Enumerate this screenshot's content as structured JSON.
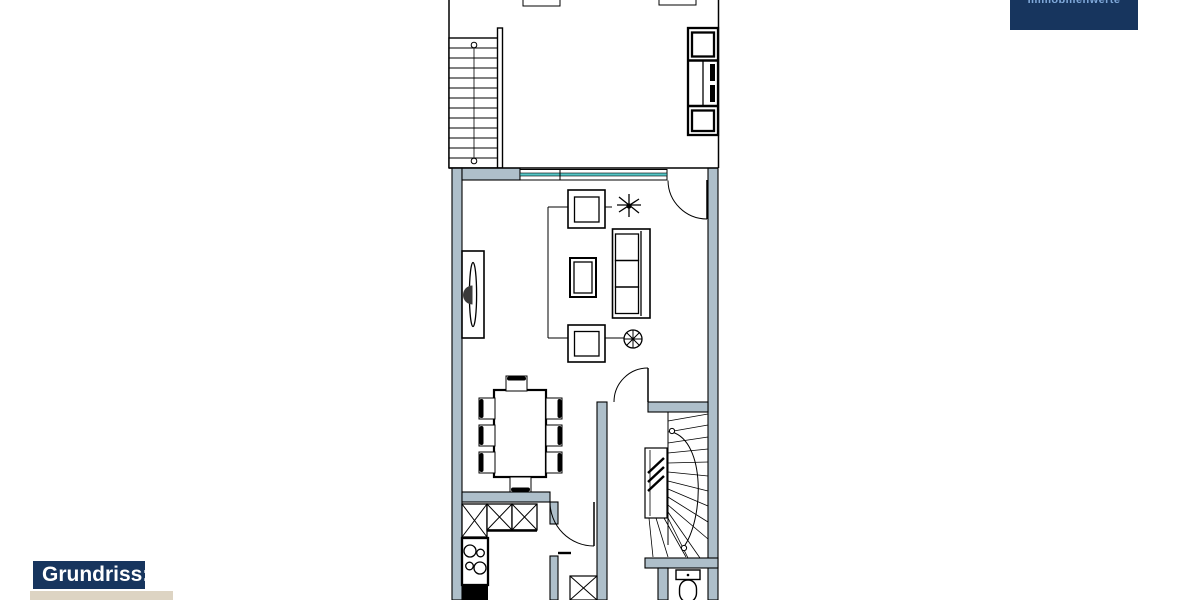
{
  "window": {
    "width": 1200,
    "height": 600,
    "background": "#ffffff"
  },
  "branding": {
    "logo_text": "Immobilienwerte"
  },
  "caption": {
    "label": "Grundriss:"
  },
  "colors": {
    "paper": "#ffffff",
    "navy": "#17355e",
    "logo_text": "#7fa8d9",
    "caption_text": "#ffffff",
    "beige": "#ddd4c3",
    "wall": "#aebfca",
    "window_glass": "#54c6c6",
    "line": "#000000"
  },
  "floorplan": {
    "type": "residential floor plan (Grundriss)",
    "rooms": [
      {
        "name": "upper-terrace-area"
      },
      {
        "name": "living-room"
      },
      {
        "name": "dining-area"
      },
      {
        "name": "kitchen"
      },
      {
        "name": "hallway"
      },
      {
        "name": "shower-room"
      },
      {
        "name": "wc"
      },
      {
        "name": "stair-hall"
      }
    ],
    "elements": [
      "straight-staircase",
      "outdoor-kitchen-unit",
      "window-front",
      "entrance-door",
      "tv-sideboard",
      "armchair",
      "sofa",
      "coffee-table",
      "plants",
      "rug",
      "dining-table-with-8-chairs",
      "kitchen-counter",
      "stove",
      "sink",
      "winder-staircase",
      "toilet",
      "shower"
    ]
  }
}
